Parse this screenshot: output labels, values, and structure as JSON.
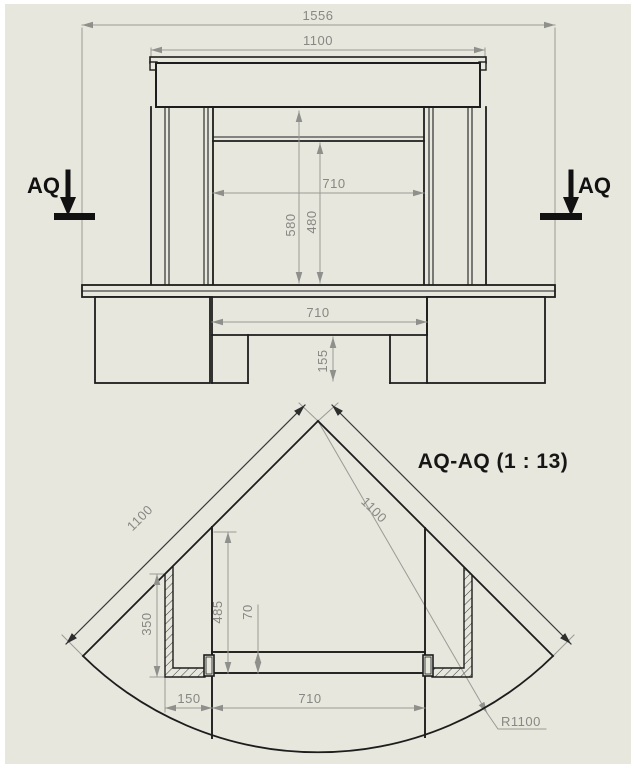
{
  "drawing": {
    "type": "cad-technical-drawing",
    "sheet_color": "#e7e7de",
    "geometry_line_color": "#1d1d1d",
    "dimension_color": "#878783",
    "front_view": {
      "description": "front elevation of corner fireplace",
      "dims": {
        "overall_width": "1556",
        "shelf_width": "1100",
        "opening_width": "710",
        "height_overall": "580",
        "height_opening": "480",
        "base_opening_width": "710",
        "plinth_height": "155"
      },
      "section_label_left": "AQ",
      "section_label_right": "AQ"
    },
    "section_view": {
      "title": "AQ-AQ (1 : 13)",
      "dims": {
        "left_length": "1100",
        "right_length": "1100",
        "side_return_depth": "350",
        "depth_front": "485",
        "hearth_thickness": "70",
        "side_offset": "150",
        "opening_width": "710",
        "radius": "R1100"
      }
    }
  }
}
